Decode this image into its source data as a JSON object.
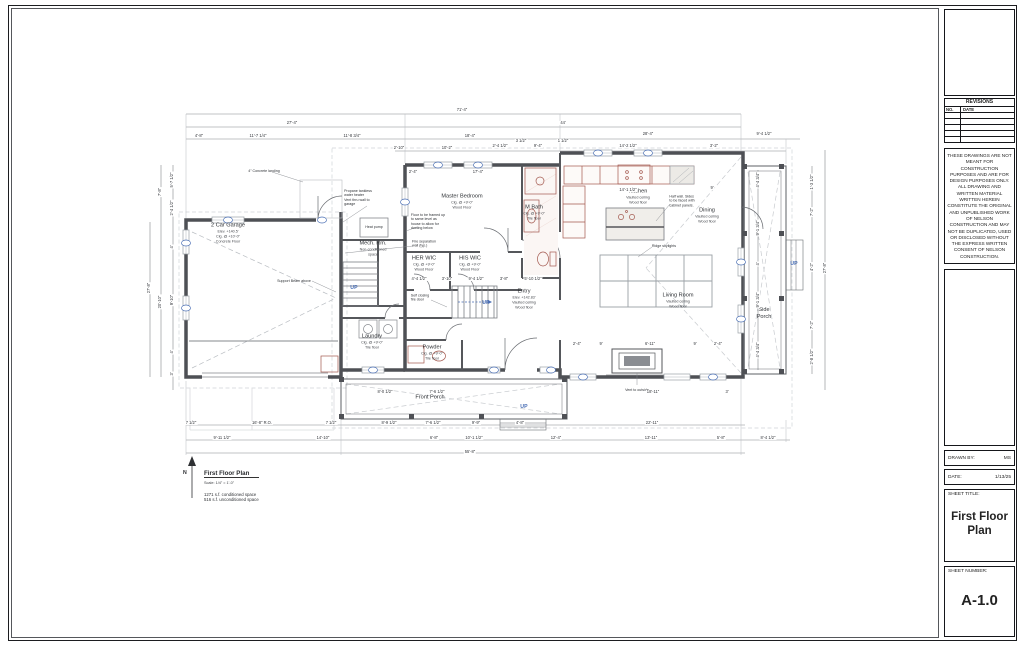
{
  "titleblock": {
    "revisions_title": "REVISIONS",
    "revisions_cols": [
      "NO.",
      "DATE"
    ],
    "disclaimer": "THESE DRAWINGS ARE NOT MEANT FOR CONSTRUCTION PURPOSES AND ARE FOR DESIGN PURPOSES ONLY. ALL DRAWING AND WRITTEN MATERIAL WRITTEN HEREIN CONSTITUTE THE ORIGINAL AND UNPUBLISHED WORK OF NELSON CONSTRUCTION AND MAY NOT BE DUPLICATED, USED OR DISCLOSED WITHOUT THE EXPRESS WRITTEN CONSENT OF NELSON CONSTRUCTION.",
    "drawn_by_label": "DRAWN BY:",
    "drawn_by": "MS",
    "date_label": "DATE:",
    "date": "1/13/25",
    "sheet_title_label": "SHEET TITLE:",
    "sheet_title": "First Floor Plan",
    "sheet_number_label": "SHEET NUMBER:",
    "sheet_number": "A-1.0"
  },
  "plan_title": {
    "title": "First Floor Plan",
    "scale": "Scale: 1/4\" = 1'-0\"",
    "area1": "1271 s.f. conditioned space",
    "area2": "516 s.f. unconditioned space",
    "north": "N"
  },
  "plan": {
    "rooms": [
      {
        "name": "2 Car Garage",
        "lines": [
          "Elev. +140.5'",
          "Clg. @ +10'-0\"",
          "Concrete Floor"
        ],
        "x": 228,
        "y": 233
      },
      {
        "name": "Mech. Rm.",
        "lines": [
          "Non-conditioned",
          "space"
        ],
        "x": 373,
        "y": 249
      },
      {
        "name": "Master Bedroom",
        "lines": [
          "Clg. @ +9'-0\"",
          "Wood Floor"
        ],
        "x": 462,
        "y": 202,
        "w": 42
      },
      {
        "name": "M Bath",
        "lines": [
          "Clg. @ +9'-0\"",
          "Tile floor"
        ],
        "x": 534,
        "y": 213
      },
      {
        "name": "HER WIC",
        "lines": [
          "Clg. @ +9'-0\"",
          "Wood Floor"
        ],
        "x": 424,
        "y": 264
      },
      {
        "name": "HIS WIC",
        "lines": [
          "Clg. @ +9'-0\"",
          "Wood Floor"
        ],
        "x": 470,
        "y": 264
      },
      {
        "name": "Kitchen",
        "lines": [
          "Vaulted ceiling",
          "Wood floor"
        ],
        "x": 638,
        "y": 197
      },
      {
        "name": "Dining",
        "lines": [
          "Vaulted ceiling",
          "Wood floor"
        ],
        "x": 707,
        "y": 216
      },
      {
        "name": "Living Room",
        "lines": [
          "Vaulted ceiling",
          "Wood floor"
        ],
        "x": 678,
        "y": 301
      },
      {
        "name": "Entry",
        "lines": [
          "Elev. +142.83'",
          "Vaulted ceiling",
          "Wood floor"
        ],
        "x": 524,
        "y": 299
      },
      {
        "name": "Laundry",
        "lines": [
          "Clg. @ +9'-0\"",
          "Tile floor"
        ],
        "x": 372,
        "y": 342
      },
      {
        "name": "Powder",
        "lines": [
          "Clg. @ +9'-0\"",
          "Tile floor"
        ],
        "x": 432,
        "y": 353
      },
      {
        "name": "Front Porch",
        "lines": [],
        "x": 430,
        "y": 398
      },
      {
        "name": "Side Porch",
        "lines": [],
        "x": 764,
        "y": 314,
        "w": 24
      }
    ],
    "annotations": [
      {
        "t": "Propane tankless\nwater heater\nVent thru wall to\ngarage",
        "x": 358,
        "y": 198
      },
      {
        "t": "4\" Concrete landing",
        "x": 264,
        "y": 171
      },
      {
        "t": "Support Beam above",
        "x": 294,
        "y": 281
      },
      {
        "t": "Floor to be framed up\nto same level as\nhouse to allow for\nducting below",
        "x": 428,
        "y": 222
      },
      {
        "t": "Fire separation\nwall (typ.)",
        "x": 424,
        "y": 244
      },
      {
        "t": "Heat pump",
        "x": 374,
        "y": 227
      },
      {
        "t": "Half wall. Sides\nto be faced with\ncabinet panels.",
        "x": 682,
        "y": 201
      },
      {
        "t": "Ridge skylights",
        "x": 664,
        "y": 246
      },
      {
        "t": "Vent to outside",
        "x": 637,
        "y": 390
      },
      {
        "t": "Self closing\nfire door",
        "x": 420,
        "y": 298
      }
    ],
    "up_labels": [
      {
        "t": "UP",
        "x": 354,
        "y": 288
      },
      {
        "t": "UP",
        "x": 486,
        "y": 303
      },
      {
        "t": "UP",
        "x": 524,
        "y": 407
      },
      {
        "t": "UP",
        "x": 794,
        "y": 264
      }
    ],
    "dimensions": [
      {
        "t": "71'-4\"",
        "x": 462,
        "y": 110
      },
      {
        "t": "27'-4\"",
        "x": 292,
        "y": 123
      },
      {
        "t": "44'",
        "x": 563,
        "y": 123
      },
      {
        "t": "4'-8\"",
        "x": 199,
        "y": 136
      },
      {
        "t": "11'-7 1/4\"",
        "x": 258,
        "y": 136
      },
      {
        "t": "11'-8 3/4\"",
        "x": 352,
        "y": 136
      },
      {
        "t": "18'-4\"",
        "x": 470,
        "y": 136
      },
      {
        "t": "28'-4\"",
        "x": 648,
        "y": 134
      },
      {
        "t": "9'-4 1/2\"",
        "x": 764,
        "y": 134
      },
      {
        "t": "2'-10\"",
        "x": 399,
        "y": 148
      },
      {
        "t": "10'-2\"",
        "x": 447,
        "y": 148
      },
      {
        "t": "2'-4 1/2\"",
        "x": 500,
        "y": 146
      },
      {
        "t": "3 1/2\"",
        "x": 521,
        "y": 141
      },
      {
        "t": "9'-4\"",
        "x": 538,
        "y": 146
      },
      {
        "t": "1 1/2\"",
        "x": 563,
        "y": 141
      },
      {
        "t": "14'-2 1/2\"",
        "x": 628,
        "y": 146
      },
      {
        "t": "3'-2\"",
        "x": 714,
        "y": 146
      },
      {
        "t": "2'-4\"",
        "x": 413,
        "y": 172
      },
      {
        "t": "17'-4\"",
        "x": 478,
        "y": 172
      },
      {
        "t": "14'-1 1/2\"",
        "x": 628,
        "y": 190
      },
      {
        "t": "9'",
        "x": 712,
        "y": 188
      },
      {
        "t": "4'-4 1/2\"",
        "x": 419,
        "y": 279
      },
      {
        "t": "3'-10\"",
        "x": 447,
        "y": 279
      },
      {
        "t": "9'-4 1/2\"",
        "x": 476,
        "y": 279
      },
      {
        "t": "3'-8\"",
        "x": 504,
        "y": 279
      },
      {
        "t": "5'-10 1/2\"",
        "x": 533,
        "y": 279
      },
      {
        "t": "2'-4\"",
        "x": 577,
        "y": 344
      },
      {
        "t": "9'",
        "x": 601,
        "y": 344
      },
      {
        "t": "6'-11\"",
        "x": 650,
        "y": 344
      },
      {
        "t": "9'",
        "x": 695,
        "y": 344
      },
      {
        "t": "2'-4\"",
        "x": 718,
        "y": 344
      },
      {
        "t": "8'-0 1/2\"",
        "x": 385,
        "y": 392
      },
      {
        "t": "7'-6 1/2\"",
        "x": 437,
        "y": 392
      },
      {
        "t": "18'-11\"",
        "x": 653,
        "y": 392
      },
      {
        "t": "3'",
        "x": 727,
        "y": 392
      },
      {
        "t": "7 1/2\"",
        "x": 191,
        "y": 423
      },
      {
        "t": "16'-8\" R.O.",
        "x": 262,
        "y": 423
      },
      {
        "t": "7 1/2\"",
        "x": 331,
        "y": 423
      },
      {
        "t": "8'-9 1/2\"",
        "x": 389,
        "y": 423
      },
      {
        "t": "7'-6 1/2\"",
        "x": 433,
        "y": 423
      },
      {
        "t": "9'-9\"",
        "x": 476,
        "y": 423
      },
      {
        "t": "4'-8\"",
        "x": 520,
        "y": 423
      },
      {
        "t": "22'-11\"",
        "x": 652,
        "y": 423
      },
      {
        "t": "9'-11 1/2\"",
        "x": 222,
        "y": 438
      },
      {
        "t": "14'-10\"",
        "x": 323,
        "y": 438
      },
      {
        "t": "6'-8\"",
        "x": 434,
        "y": 438
      },
      {
        "t": "10'-1 1/2\"",
        "x": 474,
        "y": 438
      },
      {
        "t": "12'-4\"",
        "x": 556,
        "y": 438
      },
      {
        "t": "13'-11\"",
        "x": 651,
        "y": 438
      },
      {
        "t": "5'-8\"",
        "x": 721,
        "y": 438
      },
      {
        "t": "8'-4 1/2\"",
        "x": 768,
        "y": 438
      },
      {
        "t": "55'-8\"",
        "x": 470,
        "y": 452
      },
      {
        "t": "27'-8\"",
        "x": 149,
        "y": 288,
        "v": true
      },
      {
        "t": "7'-8\"",
        "x": 160,
        "y": 192,
        "v": true
      },
      {
        "t": "20'-10\"",
        "x": 160,
        "y": 302,
        "v": true
      },
      {
        "t": "5'-7 1/2\"",
        "x": 172,
        "y": 180,
        "v": true
      },
      {
        "t": "2'-4 1/2\"",
        "x": 172,
        "y": 208,
        "v": true
      },
      {
        "t": "4'",
        "x": 172,
        "y": 247,
        "v": true
      },
      {
        "t": "9'-10\"",
        "x": 172,
        "y": 300,
        "v": true
      },
      {
        "t": "4'",
        "x": 172,
        "y": 352,
        "v": true
      },
      {
        "t": "3'",
        "x": 172,
        "y": 374,
        "v": true
      },
      {
        "t": "1'-3 1/2\"",
        "x": 812,
        "y": 182,
        "v": true
      },
      {
        "t": "7'-2\"",
        "x": 812,
        "y": 212,
        "v": true
      },
      {
        "t": "4'-2\"",
        "x": 812,
        "y": 267,
        "v": true
      },
      {
        "t": "7'-2\"",
        "x": 812,
        "y": 325,
        "v": true
      },
      {
        "t": "2'-8 1/2\"",
        "x": 812,
        "y": 357,
        "v": true
      },
      {
        "t": "4'-4 3/4\"",
        "x": 758,
        "y": 180,
        "v": true
      },
      {
        "t": "9'-1 3/4\"",
        "x": 758,
        "y": 228,
        "v": true
      },
      {
        "t": "4'",
        "x": 758,
        "y": 264,
        "v": true
      },
      {
        "t": "9'-1 3/4\"",
        "x": 758,
        "y": 300,
        "v": true
      },
      {
        "t": "4'-4 3/4\"",
        "x": 758,
        "y": 350,
        "v": true
      },
      {
        "t": "27'-8\"",
        "x": 825,
        "y": 268,
        "v": true
      }
    ]
  }
}
